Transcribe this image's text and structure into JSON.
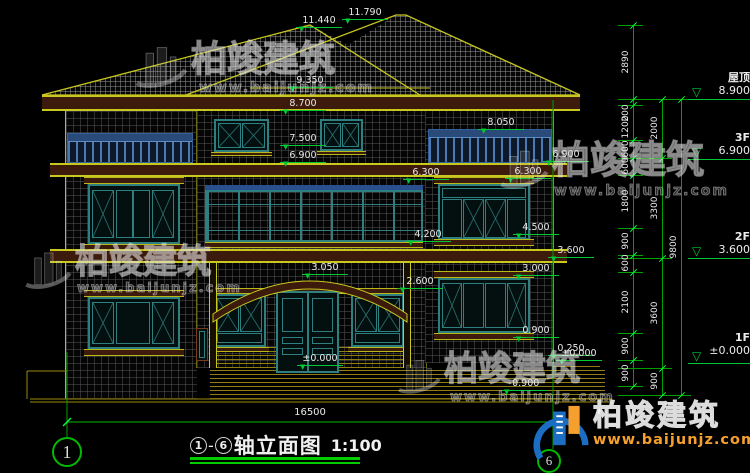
{
  "watermark": {
    "brand": "柏竣建筑",
    "url": "www.baijunjz.com"
  },
  "brand_logo": {
    "brand": "柏竣建筑",
    "url": "www.baijunjz.com"
  },
  "title": {
    "axis_from": "1",
    "dash": "-",
    "axis_to": "6",
    "text": "轴立面图",
    "scale": "1:100"
  },
  "overall_width_dim": "16500",
  "axis_bubbles": {
    "left": "1",
    "right": "6"
  },
  "floor_markers": [
    {
      "name": "屋顶",
      "elev": "8.900",
      "line_y": 99,
      "text_x": 688,
      "text_y": 72
    },
    {
      "name": "3F",
      "elev": "6.900",
      "line_y": 159,
      "text_x": 688,
      "text_y": 132
    },
    {
      "name": "2F",
      "elev": "3.600",
      "line_y": 258,
      "text_x": 688,
      "text_y": 231
    },
    {
      "name": "1F",
      "elev": "±0.000",
      "line_y": 363,
      "text_x": 688,
      "text_y": 332
    }
  ],
  "elevation_labels": [
    {
      "text": "11.440",
      "x": 296,
      "y": 16
    },
    {
      "text": "11.790",
      "x": 342,
      "y": 8
    },
    {
      "text": "9.350",
      "x": 287,
      "y": 76
    },
    {
      "text": "8.700",
      "x": 280,
      "y": 99
    },
    {
      "text": "8.050",
      "x": 478,
      "y": 118
    },
    {
      "text": "7.500",
      "x": 280,
      "y": 134
    },
    {
      "text": "6.900",
      "x": 280,
      "y": 151
    },
    {
      "text": "6.900",
      "x": 543,
      "y": 150
    },
    {
      "text": "6.300",
      "x": 403,
      "y": 168
    },
    {
      "text": "6.300",
      "x": 505,
      "y": 167
    },
    {
      "text": "4.500",
      "x": 513,
      "y": 223
    },
    {
      "text": "4.200",
      "x": 405,
      "y": 230
    },
    {
      "text": "3.600",
      "x": 548,
      "y": 246
    },
    {
      "text": "3.050",
      "x": 302,
      "y": 263
    },
    {
      "text": "3.000",
      "x": 513,
      "y": 264
    },
    {
      "text": "2.600",
      "x": 397,
      "y": 277
    },
    {
      "text": "0.900",
      "x": 513,
      "y": 326
    },
    {
      "text": "0.250",
      "x": 548,
      "y": 344
    },
    {
      "text": "±0.000",
      "x": 297,
      "y": 354
    },
    {
      "text": "±0.000",
      "x": 556,
      "y": 349
    },
    {
      "text": "-0.900",
      "x": 501,
      "y": 379
    }
  ],
  "dim_chains": [
    {
      "x": 633,
      "y1": 25,
      "y2": 386,
      "ticks": [
        25,
        99,
        105,
        140,
        158,
        175,
        228,
        255,
        272,
        333,
        360,
        386
      ],
      "labels": [
        {
          "text": "2890",
          "y": 62
        },
        {
          "text": "200",
          "y": 113
        },
        {
          "text": "1200",
          "y": 127
        },
        {
          "text": "600",
          "y": 149
        },
        {
          "text": "600",
          "y": 166
        },
        {
          "text": "1800",
          "y": 201
        },
        {
          "text": "900",
          "y": 241
        },
        {
          "text": "600",
          "y": 263
        },
        {
          "text": "2100",
          "y": 302
        },
        {
          "text": "900",
          "y": 346
        },
        {
          "text": "900",
          "y": 373
        }
      ]
    },
    {
      "x": 662,
      "y1": 99,
      "y2": 395,
      "ticks": [
        99,
        158,
        258,
        368,
        395
      ],
      "labels": [
        {
          "text": "2000",
          "y": 128
        },
        {
          "text": "3300",
          "y": 208
        },
        {
          "text": "3600",
          "y": 313
        },
        {
          "text": "900",
          "y": 381
        }
      ]
    },
    {
      "x": 681,
      "y1": 99,
      "y2": 395,
      "ticks": [
        99,
        395
      ],
      "labels": [
        {
          "text": "9800",
          "y": 247
        }
      ]
    }
  ]
}
